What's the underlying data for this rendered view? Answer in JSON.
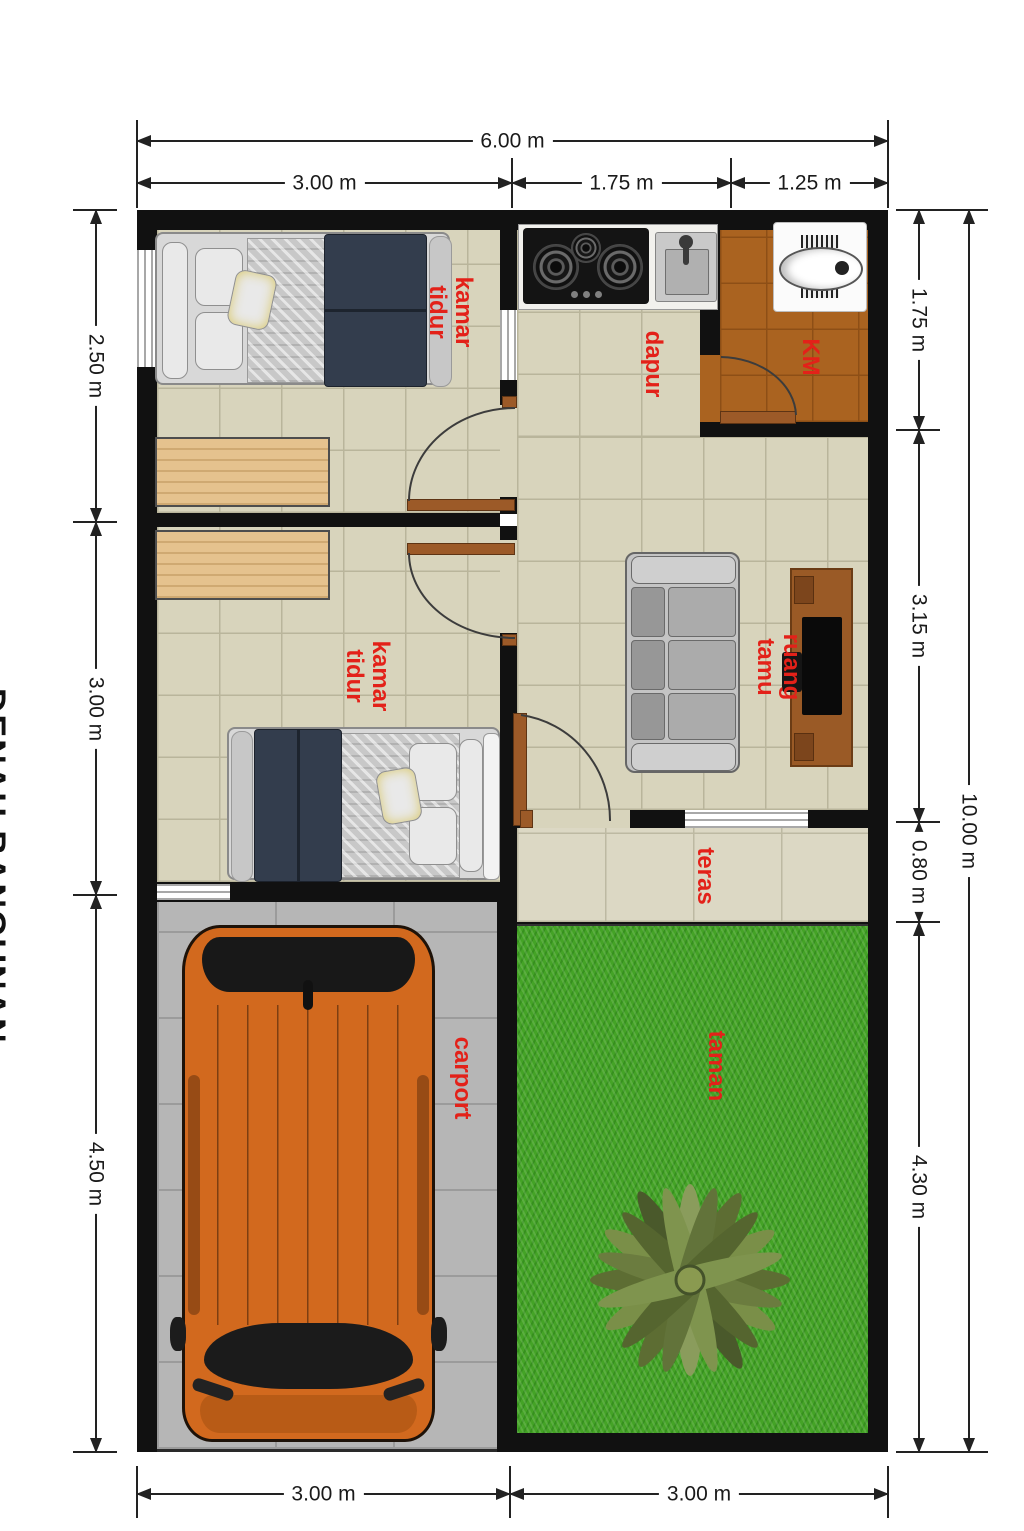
{
  "side_title": "DENAH BANGUNAN",
  "labels": {
    "bedroom1": "kamar\ntidur",
    "kitchen": "dapur",
    "bathroom": "KM",
    "bedroom2": "kamar\ntidur",
    "living": "ruang tamu",
    "terrace": "teras",
    "carport": "carport",
    "garden": "taman"
  },
  "dimensions": {
    "top_total": "6.00 m",
    "top_segments": [
      "3.00 m",
      "1.75 m",
      "1.25 m"
    ],
    "left_segments": [
      "2.50 m",
      "3.00 m",
      "4.50 m"
    ],
    "right_segments": [
      "1.75 m",
      "3.15 m",
      "0.80 m",
      "4.30 m"
    ],
    "right_total": "10.00 m",
    "bottom_segments": [
      "3.00 m",
      "3.00 m"
    ]
  },
  "colors": {
    "label_red": "#e32119",
    "wall": "#111111",
    "floor_beige": "#d8d4bc",
    "bath_brown": "#aa6320",
    "carport_gray": "#b6b6b6",
    "grass_green": "#44a326",
    "wood": "#e5c28e",
    "door_brown": "#9c5a28",
    "car_orange": "#d2691e"
  }
}
